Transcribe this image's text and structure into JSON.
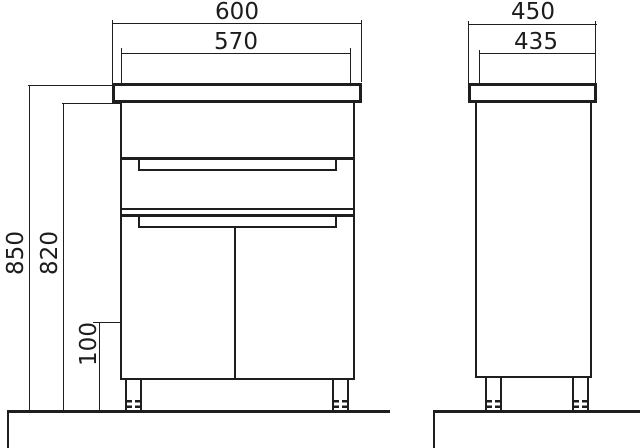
{
  "drawing": {
    "front_view": {
      "overall_width": "600",
      "cabinet_width": "570",
      "overall_height": "850",
      "cabinet_height": "820",
      "leg_height": "100"
    },
    "side_view": {
      "overall_depth": "450",
      "cabinet_depth": "435"
    }
  }
}
